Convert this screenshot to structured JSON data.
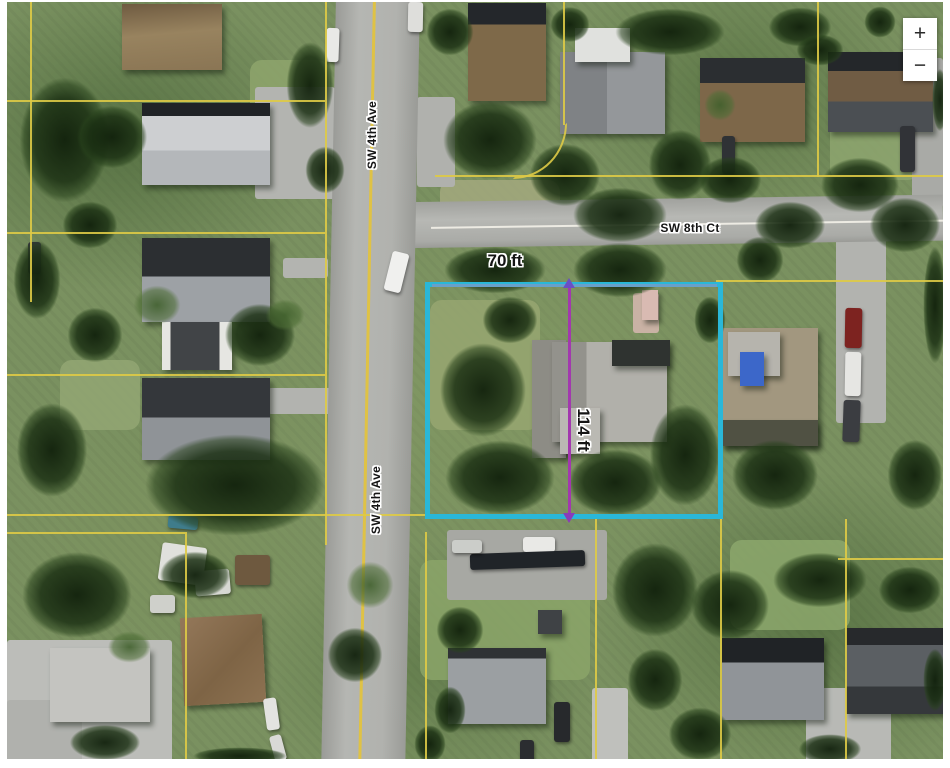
{
  "map": {
    "streets": [
      {
        "label": "SW 4th Ave",
        "orientation": "vertical"
      },
      {
        "label": "SW 8th Ct",
        "orientation": "horizontal"
      }
    ],
    "parcel": {
      "frontage_label": "70 ft",
      "depth_label": "114 ft",
      "outline_color": "#2ab7d8",
      "measure_line_color": "#a238ae",
      "boundary_line_color": "#decA46"
    },
    "controls": {
      "zoom_in": "+",
      "zoom_out": "−"
    }
  }
}
